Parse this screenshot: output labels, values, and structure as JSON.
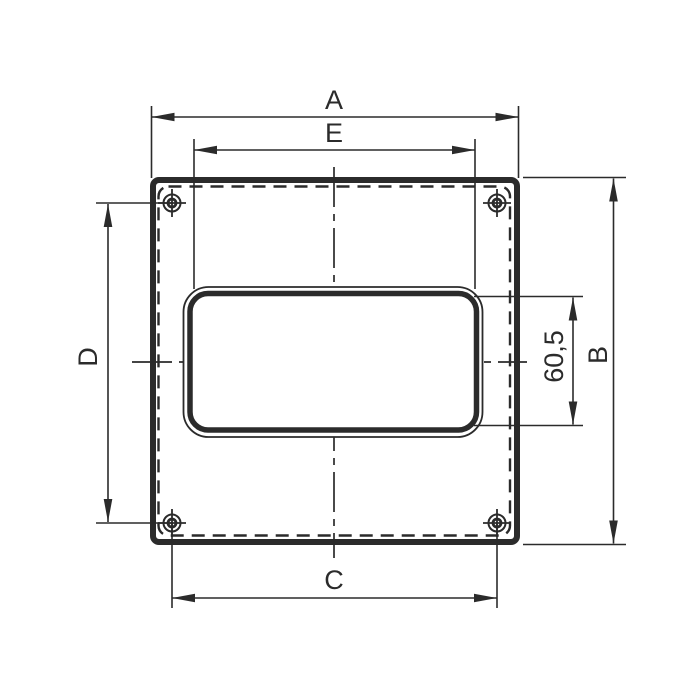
{
  "drawing": {
    "dimension_labels": {
      "overall_width": "A",
      "overall_height": "B",
      "bottom_hole_spacing": "C",
      "left_hole_spacing": "D",
      "opening_width": "E",
      "opening_height": "60,5"
    },
    "symbols": {
      "mounting_hole_marker": "crosshair-circle-icon"
    },
    "colors": {
      "line": "#2b2b2b",
      "background": "#ffffff"
    }
  }
}
